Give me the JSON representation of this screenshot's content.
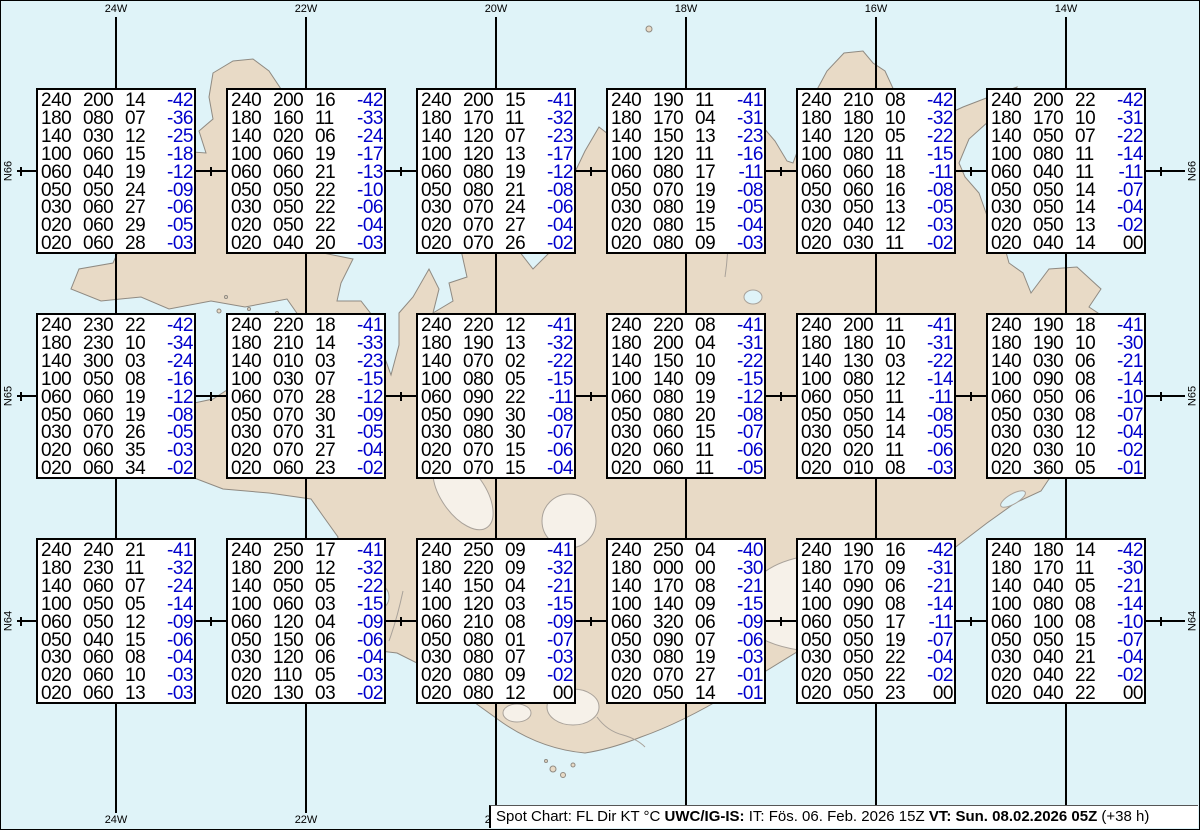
{
  "map": {
    "meridians": [
      {
        "label": "24W",
        "x": 115
      },
      {
        "label": "22W",
        "x": 305
      },
      {
        "label": "20W",
        "x": 495
      },
      {
        "label": "18W",
        "x": 685
      },
      {
        "label": "16W",
        "x": 875
      },
      {
        "label": "14W",
        "x": 1065
      }
    ],
    "parallels": [
      {
        "label": "N66",
        "y": 170
      },
      {
        "label": "N65",
        "y": 395
      },
      {
        "label": "N64",
        "y": 620
      }
    ],
    "parallel_tick_xs": [
      20,
      210,
      400,
      590,
      780,
      970,
      1160
    ],
    "colors": {
      "ocean": "#dff3f8",
      "land": "#e8dac6",
      "coast": "#8f8a82",
      "glacier": "#f6f1e9",
      "graticule": "#000000",
      "temp_blue": "#0000cc",
      "box_background": "#ffffff"
    }
  },
  "status_bar": {
    "segments": [
      {
        "text": "Spot Chart: FL Dir KT °C ",
        "bold": false
      },
      {
        "text": "UWC/IG-IS:",
        "bold": true
      },
      {
        "text": " IT: Fös. 06. Feb. 2026 15Z ",
        "bold": false
      },
      {
        "text": "VT: Sun. 08.02.2026 05Z",
        "bold": true
      },
      {
        "text": " (+38 h)",
        "bold": false
      }
    ]
  },
  "columns": [
    "FL",
    "Dir",
    "KT",
    "°C"
  ],
  "spots": [
    {
      "row": 0,
      "col": 0,
      "levels": [
        [
          "240",
          "200",
          "14",
          "-42"
        ],
        [
          "180",
          "080",
          "07",
          "-36"
        ],
        [
          "140",
          "030",
          "12",
          "-25"
        ],
        [
          "100",
          "060",
          "15",
          "-18"
        ],
        [
          "060",
          "040",
          "19",
          "-12"
        ],
        [
          "050",
          "050",
          "24",
          "-09"
        ],
        [
          "030",
          "060",
          "27",
          "-06"
        ],
        [
          "020",
          "060",
          "29",
          "-05"
        ],
        [
          "020",
          "060",
          "28",
          "-03"
        ]
      ]
    },
    {
      "row": 0,
      "col": 1,
      "levels": [
        [
          "240",
          "200",
          "16",
          "-42"
        ],
        [
          "180",
          "160",
          "11",
          "-33"
        ],
        [
          "140",
          "020",
          "06",
          "-24"
        ],
        [
          "100",
          "060",
          "19",
          "-17"
        ],
        [
          "060",
          "060",
          "21",
          "-13"
        ],
        [
          "050",
          "050",
          "22",
          "-10"
        ],
        [
          "030",
          "050",
          "22",
          "-06"
        ],
        [
          "020",
          "050",
          "22",
          "-04"
        ],
        [
          "020",
          "040",
          "20",
          "-03"
        ]
      ]
    },
    {
      "row": 0,
      "col": 2,
      "levels": [
        [
          "240",
          "200",
          "15",
          "-41"
        ],
        [
          "180",
          "170",
          "11",
          "-32"
        ],
        [
          "140",
          "120",
          "07",
          "-23"
        ],
        [
          "100",
          "120",
          "13",
          "-17"
        ],
        [
          "060",
          "080",
          "19",
          "-12"
        ],
        [
          "050",
          "080",
          "21",
          "-08"
        ],
        [
          "030",
          "070",
          "24",
          "-06"
        ],
        [
          "020",
          "070",
          "27",
          "-04"
        ],
        [
          "020",
          "070",
          "26",
          "-02"
        ]
      ]
    },
    {
      "row": 0,
      "col": 3,
      "levels": [
        [
          "240",
          "190",
          "11",
          "-41"
        ],
        [
          "180",
          "170",
          "04",
          "-31"
        ],
        [
          "140",
          "150",
          "13",
          "-23"
        ],
        [
          "100",
          "120",
          "11",
          "-16"
        ],
        [
          "060",
          "080",
          "17",
          "-11"
        ],
        [
          "050",
          "070",
          "19",
          "-08"
        ],
        [
          "030",
          "080",
          "19",
          "-05"
        ],
        [
          "020",
          "080",
          "15",
          "-04"
        ],
        [
          "020",
          "080",
          "09",
          "-03"
        ]
      ]
    },
    {
      "row": 0,
      "col": 4,
      "levels": [
        [
          "240",
          "210",
          "08",
          "-42"
        ],
        [
          "180",
          "180",
          "10",
          "-32"
        ],
        [
          "140",
          "120",
          "05",
          "-22"
        ],
        [
          "100",
          "080",
          "11",
          "-15"
        ],
        [
          "060",
          "060",
          "18",
          "-11"
        ],
        [
          "050",
          "060",
          "16",
          "-08"
        ],
        [
          "030",
          "050",
          "13",
          "-05"
        ],
        [
          "020",
          "040",
          "12",
          "-03"
        ],
        [
          "020",
          "030",
          "11",
          "-02"
        ]
      ]
    },
    {
      "row": 0,
      "col": 5,
      "levels": [
        [
          "240",
          "200",
          "22",
          "-42"
        ],
        [
          "180",
          "170",
          "10",
          "-31"
        ],
        [
          "140",
          "050",
          "07",
          "-22"
        ],
        [
          "100",
          "080",
          "11",
          "-14"
        ],
        [
          "060",
          "040",
          "11",
          "-11"
        ],
        [
          "050",
          "050",
          "14",
          "-07"
        ],
        [
          "030",
          "050",
          "14",
          "-04"
        ],
        [
          "020",
          "050",
          "13",
          "-02"
        ],
        [
          "020",
          "040",
          "14",
          "00"
        ]
      ]
    },
    {
      "row": 1,
      "col": 0,
      "levels": [
        [
          "240",
          "230",
          "22",
          "-42"
        ],
        [
          "180",
          "230",
          "10",
          "-34"
        ],
        [
          "140",
          "300",
          "03",
          "-24"
        ],
        [
          "100",
          "050",
          "08",
          "-16"
        ],
        [
          "060",
          "060",
          "19",
          "-12"
        ],
        [
          "050",
          "060",
          "19",
          "-08"
        ],
        [
          "030",
          "070",
          "26",
          "-05"
        ],
        [
          "020",
          "060",
          "35",
          "-03"
        ],
        [
          "020",
          "060",
          "34",
          "-02"
        ]
      ]
    },
    {
      "row": 1,
      "col": 1,
      "levels": [
        [
          "240",
          "220",
          "18",
          "-41"
        ],
        [
          "180",
          "210",
          "14",
          "-33"
        ],
        [
          "140",
          "010",
          "03",
          "-23"
        ],
        [
          "100",
          "030",
          "07",
          "-15"
        ],
        [
          "060",
          "070",
          "28",
          "-12"
        ],
        [
          "050",
          "070",
          "30",
          "-09"
        ],
        [
          "030",
          "070",
          "31",
          "-05"
        ],
        [
          "020",
          "070",
          "27",
          "-04"
        ],
        [
          "020",
          "060",
          "23",
          "-02"
        ]
      ]
    },
    {
      "row": 1,
      "col": 2,
      "levels": [
        [
          "240",
          "220",
          "12",
          "-41"
        ],
        [
          "180",
          "190",
          "13",
          "-32"
        ],
        [
          "140",
          "070",
          "02",
          "-22"
        ],
        [
          "100",
          "080",
          "05",
          "-15"
        ],
        [
          "060",
          "090",
          "22",
          "-11"
        ],
        [
          "050",
          "090",
          "30",
          "-08"
        ],
        [
          "030",
          "080",
          "30",
          "-07"
        ],
        [
          "020",
          "070",
          "15",
          "-06"
        ],
        [
          "020",
          "070",
          "15",
          "-04"
        ]
      ]
    },
    {
      "row": 1,
      "col": 3,
      "levels": [
        [
          "240",
          "220",
          "08",
          "-41"
        ],
        [
          "180",
          "200",
          "04",
          "-31"
        ],
        [
          "140",
          "150",
          "10",
          "-22"
        ],
        [
          "100",
          "140",
          "09",
          "-15"
        ],
        [
          "060",
          "080",
          "19",
          "-12"
        ],
        [
          "050",
          "080",
          "20",
          "-08"
        ],
        [
          "030",
          "060",
          "15",
          "-07"
        ],
        [
          "020",
          "060",
          "11",
          "-06"
        ],
        [
          "020",
          "060",
          "11",
          "-05"
        ]
      ]
    },
    {
      "row": 1,
      "col": 4,
      "levels": [
        [
          "240",
          "200",
          "11",
          "-41"
        ],
        [
          "180",
          "180",
          "10",
          "-31"
        ],
        [
          "140",
          "130",
          "03",
          "-22"
        ],
        [
          "100",
          "080",
          "12",
          "-14"
        ],
        [
          "060",
          "050",
          "11",
          "-11"
        ],
        [
          "050",
          "050",
          "14",
          "-08"
        ],
        [
          "030",
          "050",
          "14",
          "-05"
        ],
        [
          "020",
          "020",
          "11",
          "-06"
        ],
        [
          "020",
          "010",
          "08",
          "-03"
        ]
      ]
    },
    {
      "row": 1,
      "col": 5,
      "levels": [
        [
          "240",
          "190",
          "18",
          "-41"
        ],
        [
          "180",
          "190",
          "10",
          "-30"
        ],
        [
          "140",
          "030",
          "06",
          "-21"
        ],
        [
          "100",
          "090",
          "08",
          "-14"
        ],
        [
          "060",
          "050",
          "06",
          "-10"
        ],
        [
          "050",
          "030",
          "08",
          "-07"
        ],
        [
          "030",
          "030",
          "12",
          "-04"
        ],
        [
          "020",
          "030",
          "10",
          "-02"
        ],
        [
          "020",
          "360",
          "05",
          "-01"
        ]
      ]
    },
    {
      "row": 2,
      "col": 0,
      "levels": [
        [
          "240",
          "240",
          "21",
          "-41"
        ],
        [
          "180",
          "230",
          "11",
          "-32"
        ],
        [
          "140",
          "060",
          "07",
          "-24"
        ],
        [
          "100",
          "050",
          "05",
          "-14"
        ],
        [
          "060",
          "050",
          "12",
          "-09"
        ],
        [
          "050",
          "040",
          "15",
          "-06"
        ],
        [
          "030",
          "060",
          "08",
          "-04"
        ],
        [
          "020",
          "060",
          "10",
          "-03"
        ],
        [
          "020",
          "060",
          "13",
          "-03"
        ]
      ]
    },
    {
      "row": 2,
      "col": 1,
      "levels": [
        [
          "240",
          "250",
          "17",
          "-41"
        ],
        [
          "180",
          "200",
          "12",
          "-32"
        ],
        [
          "140",
          "050",
          "05",
          "-22"
        ],
        [
          "100",
          "060",
          "03",
          "-15"
        ],
        [
          "060",
          "120",
          "04",
          "-09"
        ],
        [
          "050",
          "150",
          "06",
          "-06"
        ],
        [
          "030",
          "120",
          "06",
          "-04"
        ],
        [
          "020",
          "110",
          "05",
          "-03"
        ],
        [
          "020",
          "130",
          "03",
          "-02"
        ]
      ]
    },
    {
      "row": 2,
      "col": 2,
      "levels": [
        [
          "240",
          "250",
          "09",
          "-41"
        ],
        [
          "180",
          "220",
          "09",
          "-32"
        ],
        [
          "140",
          "150",
          "04",
          "-21"
        ],
        [
          "100",
          "120",
          "03",
          "-15"
        ],
        [
          "060",
          "210",
          "08",
          "-09"
        ],
        [
          "050",
          "080",
          "01",
          "-07"
        ],
        [
          "030",
          "080",
          "07",
          "-03"
        ],
        [
          "020",
          "080",
          "09",
          "-02"
        ],
        [
          "020",
          "080",
          "12",
          "00"
        ]
      ]
    },
    {
      "row": 2,
      "col": 3,
      "levels": [
        [
          "240",
          "250",
          "04",
          "-40"
        ],
        [
          "180",
          "000",
          "00",
          "-30"
        ],
        [
          "140",
          "170",
          "08",
          "-21"
        ],
        [
          "100",
          "140",
          "09",
          "-15"
        ],
        [
          "060",
          "320",
          "06",
          "-09"
        ],
        [
          "050",
          "090",
          "07",
          "-06"
        ],
        [
          "030",
          "080",
          "19",
          "-03"
        ],
        [
          "020",
          "070",
          "27",
          "-01"
        ],
        [
          "020",
          "050",
          "14",
          "-01"
        ]
      ]
    },
    {
      "row": 2,
      "col": 4,
      "levels": [
        [
          "240",
          "190",
          "16",
          "-42"
        ],
        [
          "180",
          "170",
          "09",
          "-31"
        ],
        [
          "140",
          "090",
          "06",
          "-21"
        ],
        [
          "100",
          "090",
          "08",
          "-14"
        ],
        [
          "060",
          "050",
          "17",
          "-11"
        ],
        [
          "050",
          "050",
          "19",
          "-07"
        ],
        [
          "030",
          "050",
          "22",
          "-04"
        ],
        [
          "020",
          "050",
          "22",
          "-02"
        ],
        [
          "020",
          "050",
          "23",
          "00"
        ]
      ]
    },
    {
      "row": 2,
      "col": 5,
      "levels": [
        [
          "240",
          "180",
          "14",
          "-42"
        ],
        [
          "180",
          "170",
          "11",
          "-30"
        ],
        [
          "140",
          "040",
          "05",
          "-21"
        ],
        [
          "100",
          "080",
          "08",
          "-14"
        ],
        [
          "060",
          "100",
          "08",
          "-10"
        ],
        [
          "050",
          "050",
          "15",
          "-07"
        ],
        [
          "030",
          "040",
          "21",
          "-04"
        ],
        [
          "020",
          "040",
          "22",
          "-02"
        ],
        [
          "020",
          "040",
          "22",
          "00"
        ]
      ]
    }
  ]
}
